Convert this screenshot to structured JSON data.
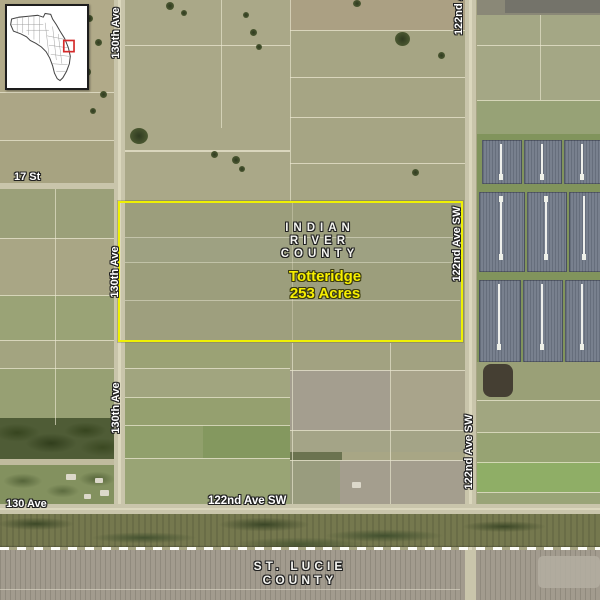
{
  "labels": {
    "indian_river": {
      "line1": "INDIAN",
      "line2": "RIVER",
      "line3": "COUNTY"
    },
    "property": {
      "name": "Totteridge",
      "acres": "253 Acres"
    },
    "st_lucie": {
      "line1": "ST. LUCIE",
      "line2": "COUNTY"
    },
    "roads": {
      "ave_130th": "130th Ave",
      "ave_122nd_sw": "122nd Ave SW",
      "ave_122nd": "122nd Ave",
      "st_17": "17 St",
      "ave_130": "130 Ave"
    }
  },
  "inset": {
    "description": "Florida county locator map",
    "highlight_color": "#d42a2a"
  },
  "colors": {
    "property_boundary": "#eff104",
    "property_text": "#f7ef00",
    "road_label_text": "#ffffff"
  }
}
